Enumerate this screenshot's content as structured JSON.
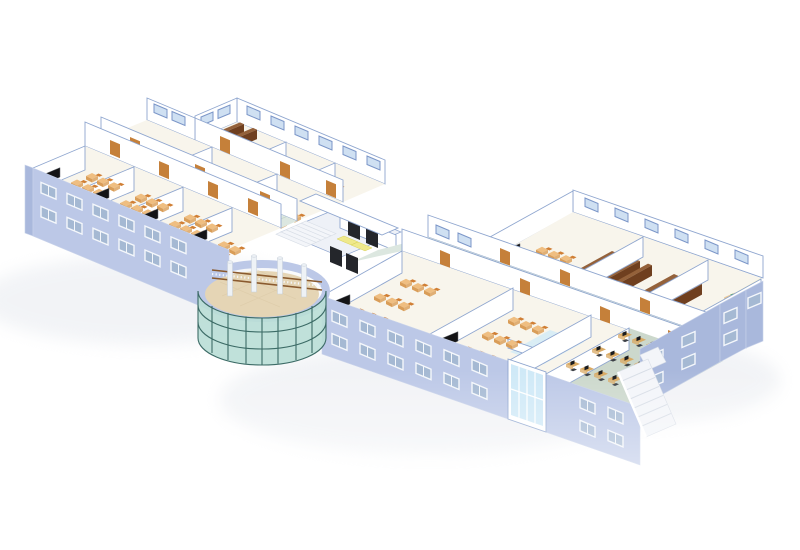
{
  "scene": {
    "image_type": "3d-architectural-rendering",
    "description": "Isometric cutaway rendering of a school building with two classroom wings, a central glass rotunda atrium, entrance stairs, library stack rooms, a science lab and a computer lab",
    "background": "#ffffff"
  },
  "colors": {
    "wall_facade": "#bcc8e7",
    "wall_facade_dark": "#a9b8dc",
    "wall_trim": "#c9d3ea",
    "wall_white": "#ffffff",
    "wall_shade": "#eef1f7",
    "wall_edge": "#8fa6cf",
    "floor_room": "#f8f5ec",
    "floor_corridor": "#dce7e0",
    "corridor_line": "#c6d5cc",
    "floor_atrium": "#e5d5b5",
    "floor_lab": "#f7f0bd",
    "floor_computer": "#ccd8cc",
    "floor_bath": "#d9edf5",
    "window_glass": "#a5b9d3",
    "window_frame": "#f4f7fb",
    "window_frame_blue": "#7b96c8",
    "window_glass_blue": "#cfe0f2",
    "glass_curtain": "#b9ded6",
    "glass_mullion": "#3c6b66",
    "glass_stairwell": "#cfe9f7",
    "door": "#c5803a",
    "entrance_door": "#24262b",
    "blackboard": "#141416",
    "student_desk": "#efbe81",
    "student_desk_side": "#d99d58",
    "chair": "#d07f35",
    "teacher_desk": "#6e3a1b",
    "bookshelf": "#6f3f1f",
    "bookshelf_top": "#94613a",
    "monitor": "#1a1c1f",
    "pc_desk": "#d9aa64",
    "office_chair": "#3c4046",
    "lab_bench": "#e9c793",
    "lab_equipment": "#2f9e54",
    "lab_chair": "#d42b28",
    "railing": "#8a5a2e",
    "baluster": "#f4f6f9",
    "column": "#eef2f6",
    "column_edge": "#c6cfd9",
    "stair": "#f3f5f9",
    "stair_shade": "#d7dde6",
    "mat_yellow": "#efe98c",
    "shadow": "#dfe3ea"
  },
  "building": {
    "left_wing": {
      "front_row": {
        "rooms": [
          {
            "type": "classroom",
            "furniture": [
              "blackboard",
              "teacher-desk",
              "student-desks"
            ]
          }
        ],
        "classroom_count": 4
      },
      "corridor": true,
      "middle_row": {
        "rooms": [
          {
            "type": "library-stacks"
          },
          {
            "type": "classroom"
          },
          {
            "type": "classroom"
          }
        ]
      },
      "back_row": {
        "rooms": [
          {
            "type": "library-stacks"
          },
          {
            "type": "classroom"
          },
          {
            "type": "classroom"
          }
        ]
      }
    },
    "center": {
      "features": [
        "entrance-stairs",
        "yellow-floor-mats",
        "dark-entrance-doors",
        "glass-rotunda-atrium",
        "balcony-railing",
        "columns",
        "tiled-atrium-floor"
      ]
    },
    "right_wing": {
      "front_row": {
        "rooms": [
          {
            "type": "classroom"
          },
          {
            "type": "classroom"
          },
          {
            "type": "restrooms"
          },
          {
            "type": "computer-lab",
            "furniture": [
              "pc-desks",
              "monitors",
              "office-chairs"
            ]
          }
        ]
      },
      "corridor": true,
      "back_row": {
        "rooms": [
          {
            "type": "classroom"
          },
          {
            "type": "library-stacks"
          },
          {
            "type": "library-stacks"
          },
          {
            "type": "science-lab",
            "furniture": [
              "lab-benches",
              "green-equipment",
              "red-chairs"
            ]
          }
        ]
      }
    },
    "exterior": [
      "lavender-facades-with-windows",
      "glass-stairwell",
      "external-staircase",
      "soft-ground-shadow"
    ]
  }
}
